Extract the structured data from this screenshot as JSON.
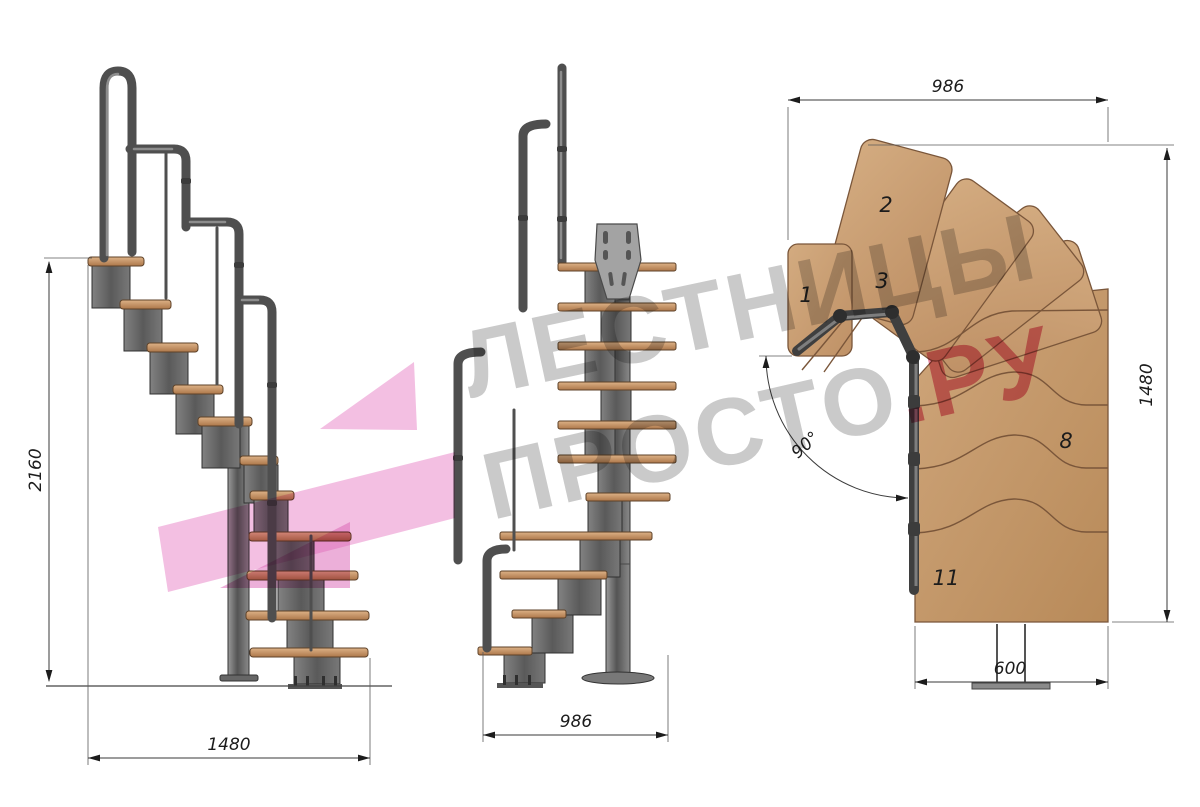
{
  "watermark": {
    "line1": "ЛЕСТНИЦЫ",
    "line2_gray": "ПРОСТО",
    "line2_pink": ".РУ"
  },
  "views": {
    "side_elevation": {
      "dim_height_mm": "2160",
      "dim_width_mm": "1480"
    },
    "front_elevation": {
      "dim_width_mm": "986"
    },
    "plan": {
      "dim_width_mm": "986",
      "dim_height_mm": "1480",
      "dim_exit_width_mm": "600",
      "dim_turn_angle": "90°",
      "tread_numbers": [
        "1",
        "2",
        "3",
        "8",
        "11"
      ]
    }
  },
  "colors": {
    "wood": "#c79d72",
    "steel": "#6e6e6e",
    "dimension_lines": "#3a3a3a",
    "watermark_gray": "#8a8a8a",
    "watermark_pink": "#d63c66",
    "logo_pink": "#e87fc6"
  }
}
